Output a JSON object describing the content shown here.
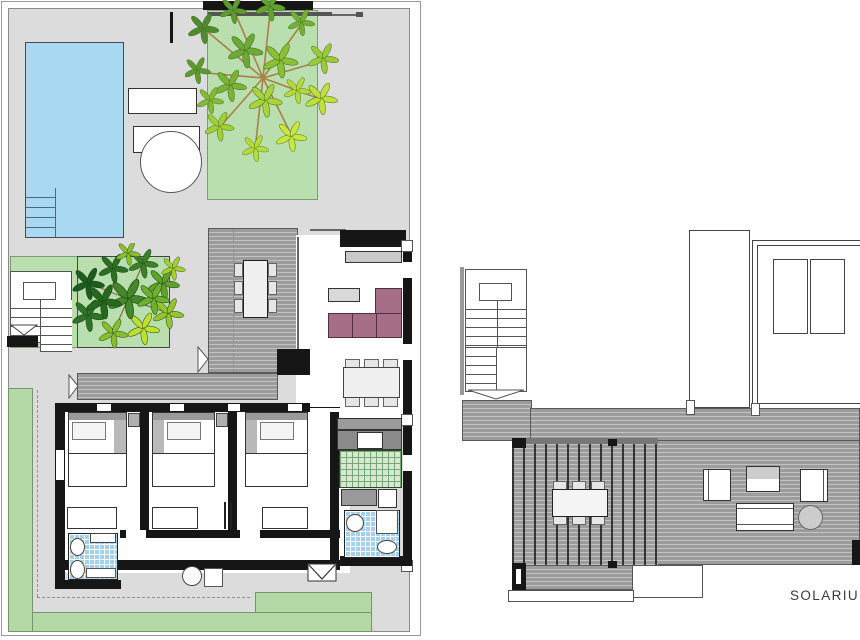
{
  "labels": {
    "solarium": "SOLARIUM"
  },
  "colors": {
    "terrace": "#dcdcdc",
    "pool": "#a9d8f3",
    "garden": "#b9dfae",
    "lawn": "#b4d9a6",
    "deck_base": "#9c9c9c",
    "deck_line": "#c3c3c3",
    "wall": "#161616",
    "sofa": "#a76e87",
    "mosaic": "#a6cfe9",
    "kitchen_tile": "#d7e8d0",
    "kitchen_grid": "#74a874",
    "item_gray": "#c9c9c9",
    "text": "#3a3a3a"
  }
}
